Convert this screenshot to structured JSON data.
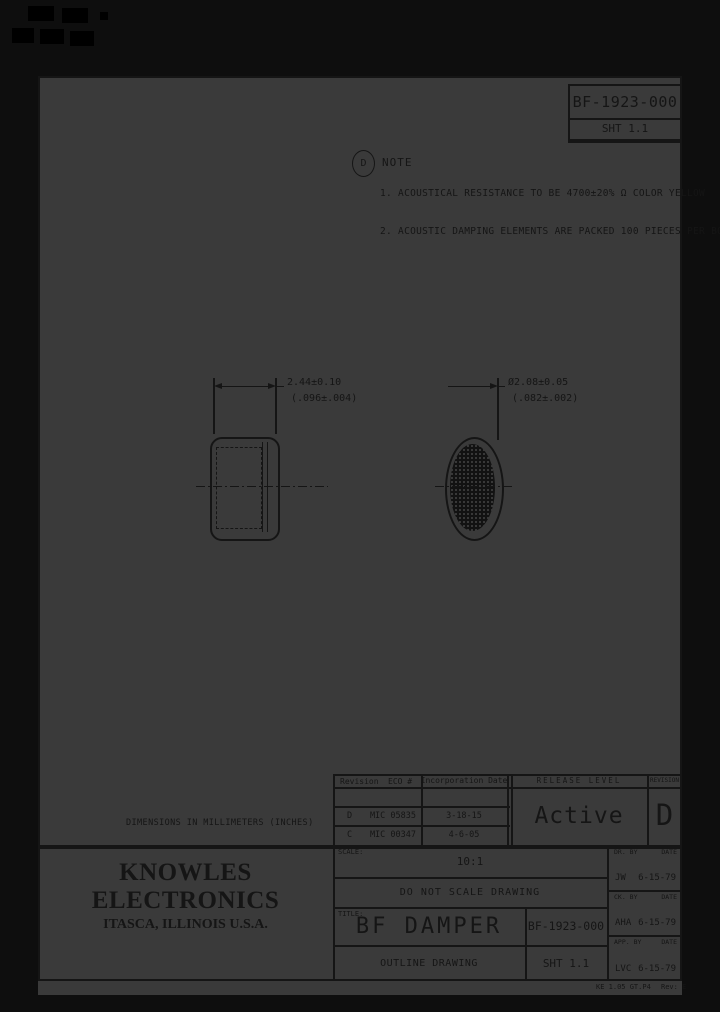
{
  "colors": {
    "paper": "#3a3a3a",
    "ink": "#151515",
    "margin": "#0e0e0e"
  },
  "header_box": {
    "drawing_number": "BF-1923-000",
    "sheet": "SHT 1.1"
  },
  "notes": {
    "flag_letter": "D",
    "heading": "NOTE",
    "item_1": "1. ACOUSTICAL RESISTANCE TO BE 4700±20% Ω COLOR YELLOW",
    "item_2": "2. ACOUSTIC DAMPING ELEMENTS ARE PACKED 100 PIECES PER BOX"
  },
  "views": {
    "width_dim_mm": "2.44±0.10",
    "width_dim_in": "(.096±.004)",
    "dia_dim_mm": "Ø2.08±0.05",
    "dia_dim_in": "(.082±.002)"
  },
  "units_note": "DIMENSIONS IN MILLIMETERS (INCHES)",
  "revision_table": {
    "col_revision": "Revision",
    "col_eco": "ECO #",
    "col_date": "Incorporation Date",
    "col_release": "RELEASE LEVEL",
    "col_rev": "REVISION",
    "rows": [
      {
        "rev": "D",
        "eco": "MIC 05835",
        "date": "3-18-15"
      },
      {
        "rev": "C",
        "eco": "MIC 00347",
        "date": "4-6-05"
      }
    ],
    "release_level": "Active",
    "current_revision": "D"
  },
  "title_block": {
    "company": "KNOWLES ELECTRONICS",
    "location": "ITASCA, ILLINOIS U.S.A.",
    "scale_label": "SCALE:",
    "scale_value": "10:1",
    "no_scale_note": "DO NOT SCALE DRAWING",
    "title_label": "TITLE:",
    "title": "BF DAMPER",
    "drawing_number": "BF-1923-000",
    "subtitle": "OUTLINE DRAWING",
    "sheet": "SHT 1.1",
    "signoffs": [
      {
        "role": "DR. BY",
        "date_label": "DATE",
        "initials": "JW",
        "date": "6-15-79"
      },
      {
        "role": "CK. BY",
        "date_label": "DATE",
        "initials": "AHA",
        "date": "6-15-79"
      },
      {
        "role": "APP. BY",
        "date_label": "DATE",
        "initials": "LVC",
        "date": "6-15-79"
      }
    ]
  },
  "footer": {
    "form_ref": "KE 1.05 GT.P4",
    "rev_note": "Rev: E"
  }
}
